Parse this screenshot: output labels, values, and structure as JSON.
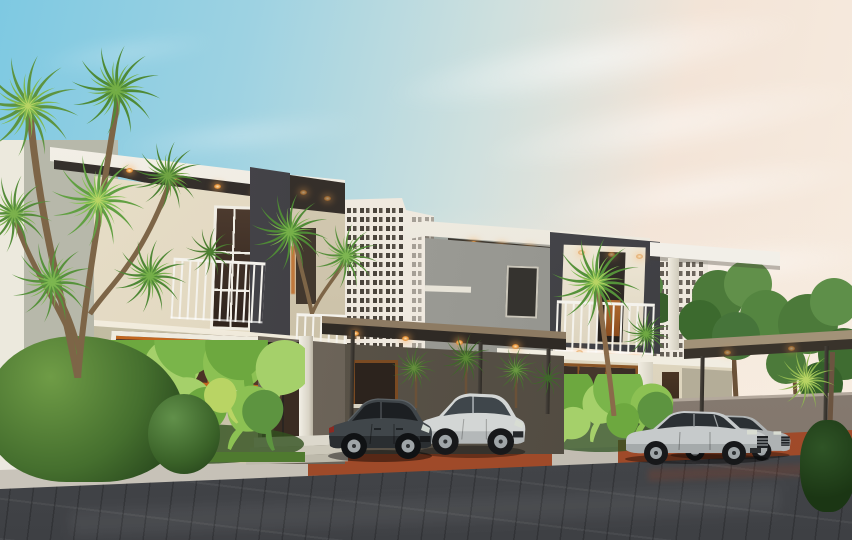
{
  "scene": {
    "type": "3d-architectural-render",
    "subject": "Two modern two-storey villas with flat white roof slabs, charcoal frame boxes, balconies, carport canopies with warm downlights, four parked cars, tropical palms and shrubs, paved street in the foreground and white high-rise blocks behind",
    "time_of_day": "dusk",
    "counts": {
      "houses": 2,
      "cars": 4,
      "carport_canopies": 2,
      "high_rise_buildings": 2,
      "palm_trees": 5
    }
  },
  "palette": {
    "sky_top": "#7ec9e2",
    "sky_mid": "#b5dce7",
    "sky_warm": "#f3e4d7",
    "sky_horizon": "#f7ece0",
    "cloud_white": "#ffffff",
    "roof_white": "#f2efe8",
    "charcoal": "#3f3e42",
    "soffit_dark": "#2e2a26",
    "cream_wall": "#e6ddc8",
    "cream_panel": "#ddd2b8",
    "sage_wall": "#b2b3a5",
    "olive_wall": "#5a544a",
    "gray_body": "#9c9c96",
    "orange_frame": "#c2661f",
    "wood_frame": "#8a5526",
    "glass_dark": "#3c2d24",
    "rail_white": "#f4f2ec",
    "building_white": "#efe9df",
    "building_window": "#4a443c",
    "canopy_top": "#8d7b63",
    "canopy_edge": "#322d27",
    "wall_taupe": "#8b8077",
    "sidewalk": "#c6c1b6",
    "road_gray": "#54565a",
    "road_dark": "#404247",
    "terracotta": "#a8502e",
    "car_graphite": "#3c4145",
    "car_silver": "#c9cccc",
    "tire_black": "#17181a",
    "rim_silver": "#9fa5a8",
    "leaf_dark": "#3e6e2e",
    "leaf_mid": "#5d9440",
    "leaf_light": "#8cc155",
    "leaf_accent": "#b9d464",
    "trunk_brown": "#7d6547",
    "warm_light": "#ffb24d"
  }
}
